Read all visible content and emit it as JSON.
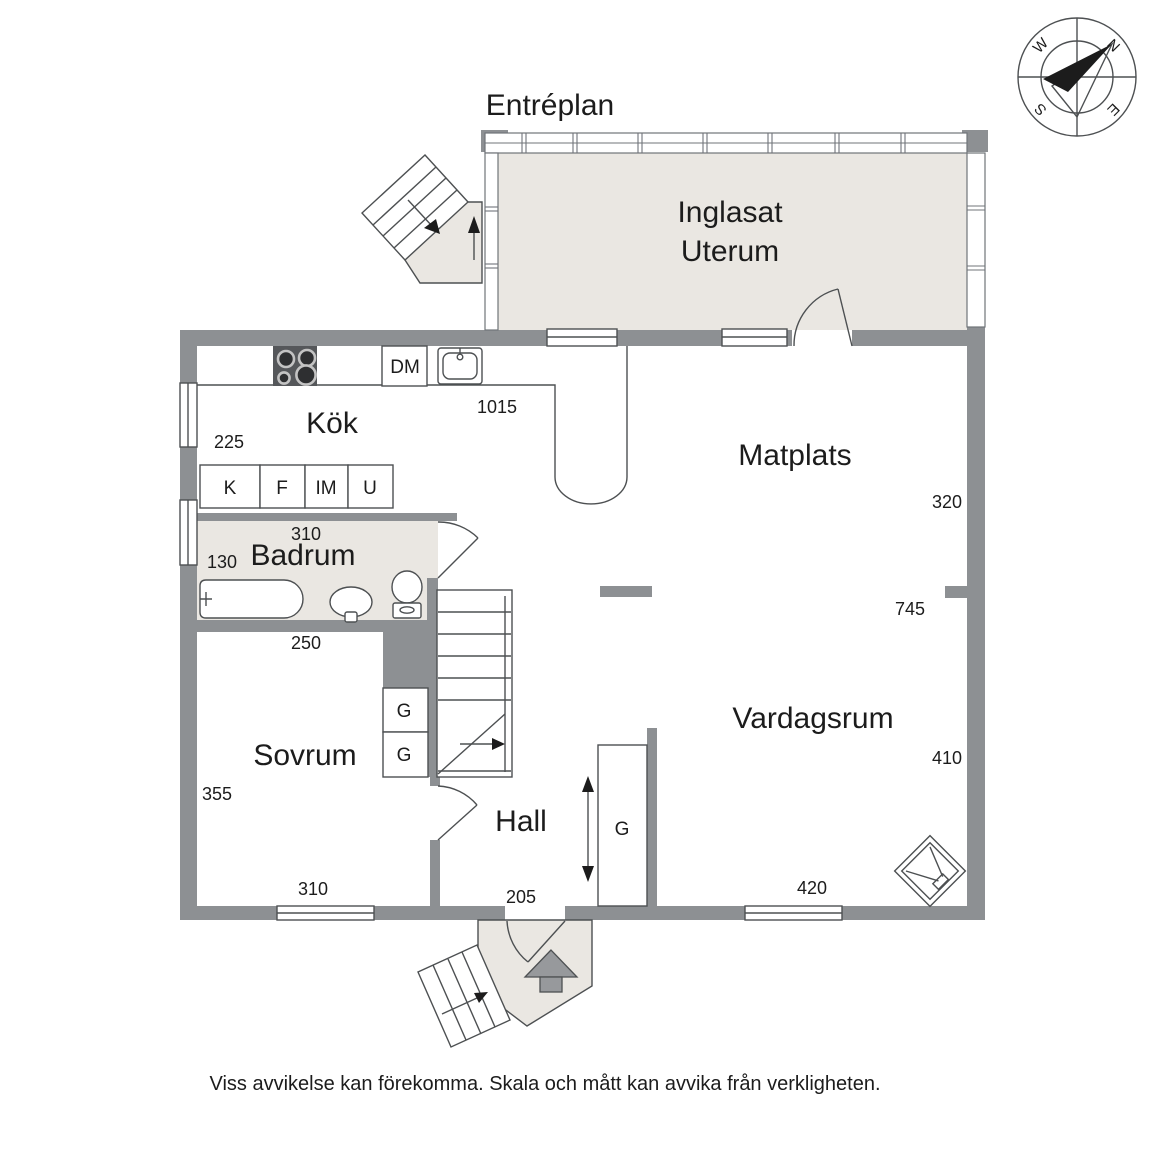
{
  "title": "Entréplan",
  "disclaimer": "Viss avvikelse kan förekomma. Skala och mått kan avvika från verkligheten.",
  "compass": {
    "north": "N",
    "east": "E",
    "south": "S",
    "west": "W"
  },
  "rooms": {
    "uterum_line1": "Inglasat",
    "uterum_line2": "Uterum",
    "kitchen": "Kök",
    "dining": "Matplats",
    "bathroom": "Badrum",
    "bedroom": "Sovrum",
    "hall": "Hall",
    "living": "Vardagsrum"
  },
  "fixtures": {
    "dishwasher": "DM",
    "cabinets": [
      "K",
      "F",
      "IM",
      "U"
    ],
    "bedroom_closet_1": "G",
    "bedroom_closet_2": "G",
    "hall_wardrobe": "G"
  },
  "dimensions": {
    "kitchen_width": "1015",
    "kitchen_depth": "225",
    "bathroom_width": "310",
    "bathroom_depth": "130",
    "bedroom_top": "250",
    "bedroom_left": "355",
    "bedroom_bottom": "310",
    "hall_bottom": "205",
    "dining_right": "320",
    "living_right_upper": "745",
    "living_right": "410",
    "living_bottom": "420"
  },
  "colors": {
    "wall": "#8d9093",
    "floor_accent": "#eae7e2",
    "line": "#4d5052",
    "text": "#1c1c1c",
    "stove": "#55575a",
    "entrance_arrow": "#97999c"
  }
}
